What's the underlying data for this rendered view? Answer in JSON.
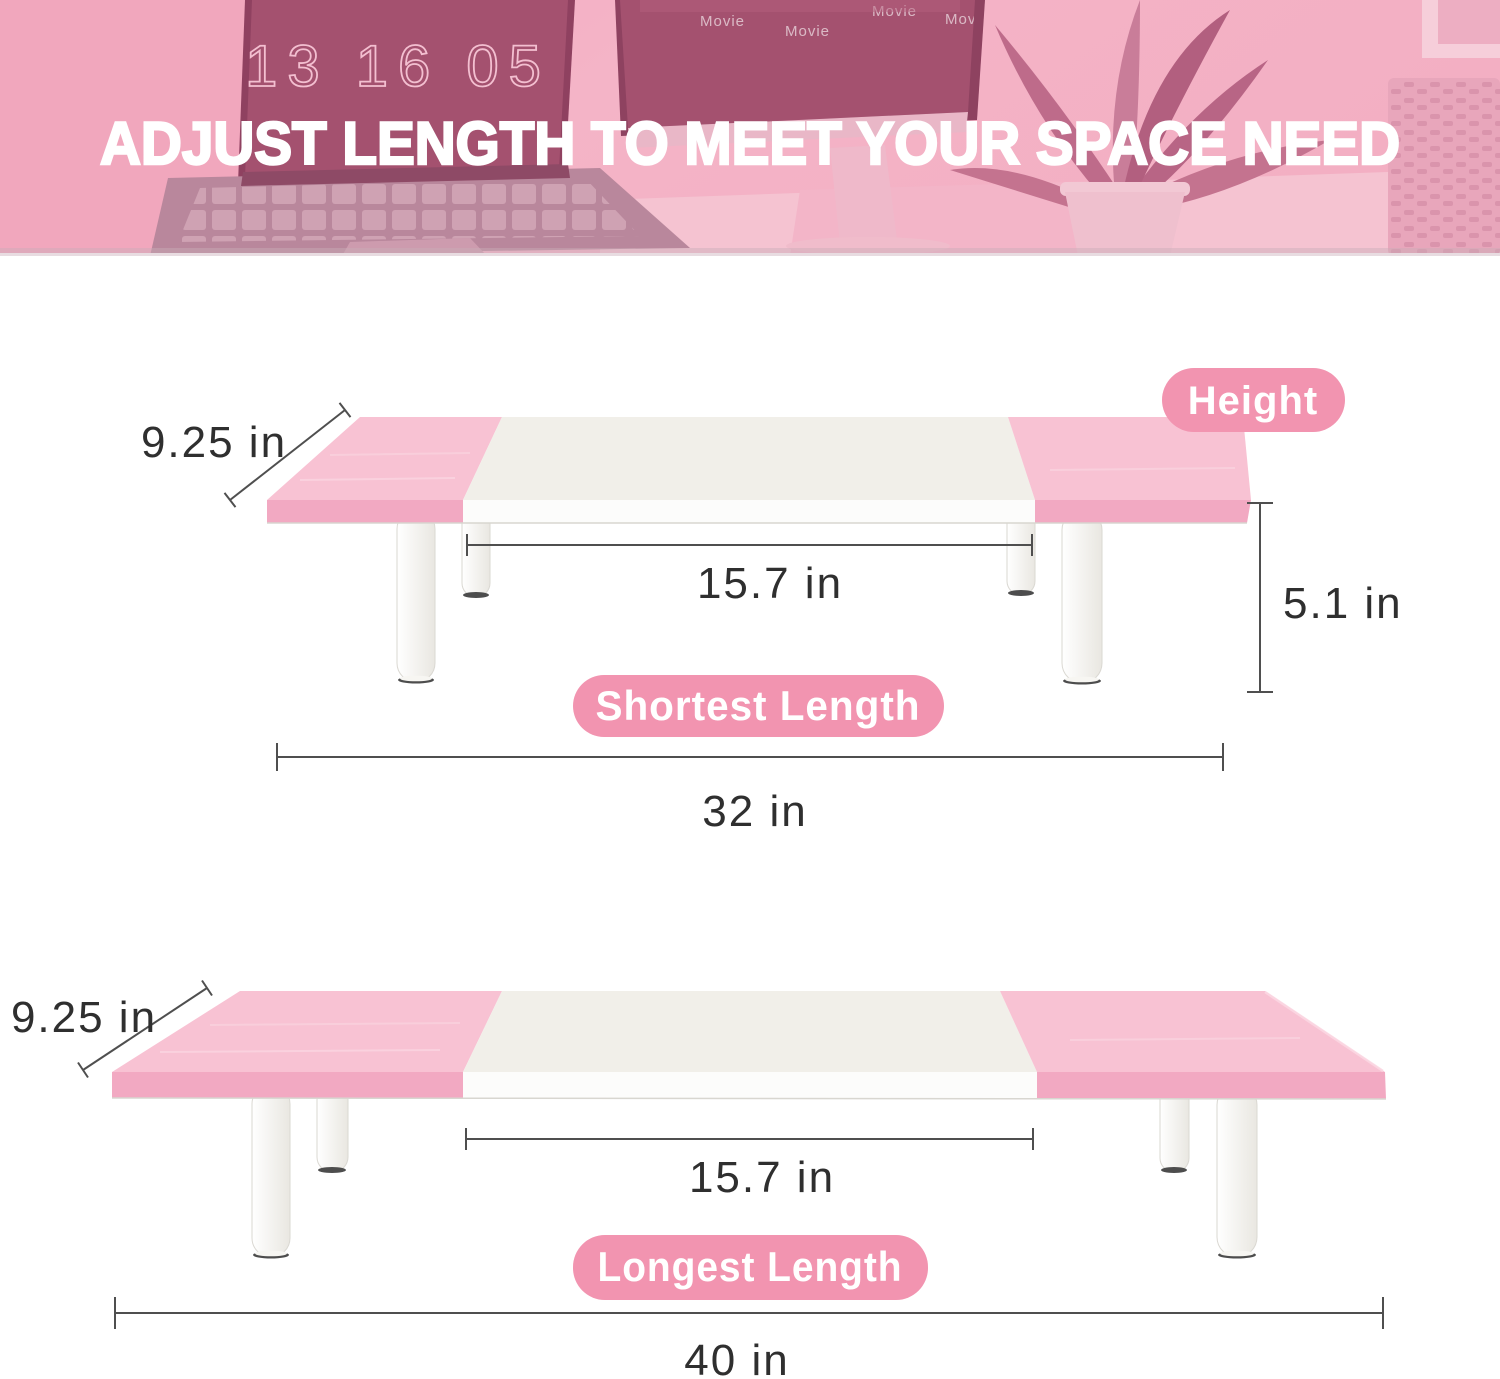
{
  "banner": {
    "headline": "ADJUST LENGTH TO MEET YOUR SPACE NEED",
    "clock_time": "13 16 05",
    "movie_labels": [
      "Movie",
      "Movie",
      "Movie",
      "Movie",
      "Movie"
    ]
  },
  "badges": {
    "height": "Height",
    "shortest": "Shortest Length",
    "longest": "Longest Length"
  },
  "diagram_shortest": {
    "depth": "9.25 in",
    "platform_length": "15.7 in",
    "height": "5.1 in",
    "total_length": "32 in"
  },
  "diagram_longest": {
    "depth": "9.25 in",
    "platform_length": "15.7 in",
    "total_length": "40 in"
  },
  "colors": {
    "badge_pink": "#F294B0",
    "board_pink_top": "#F8C2D3",
    "board_pink_edge": "#F2A9C2",
    "board_white_top": "#F1EFE9",
    "board_white_edge": "#FCFCFB",
    "leg_fill": "#F7F6F2",
    "dim_line": "#4F4F4F",
    "dim_text": "#2F2F2F",
    "banner_screen": "#A4516F",
    "banner_pink": "#F2ADC1"
  }
}
